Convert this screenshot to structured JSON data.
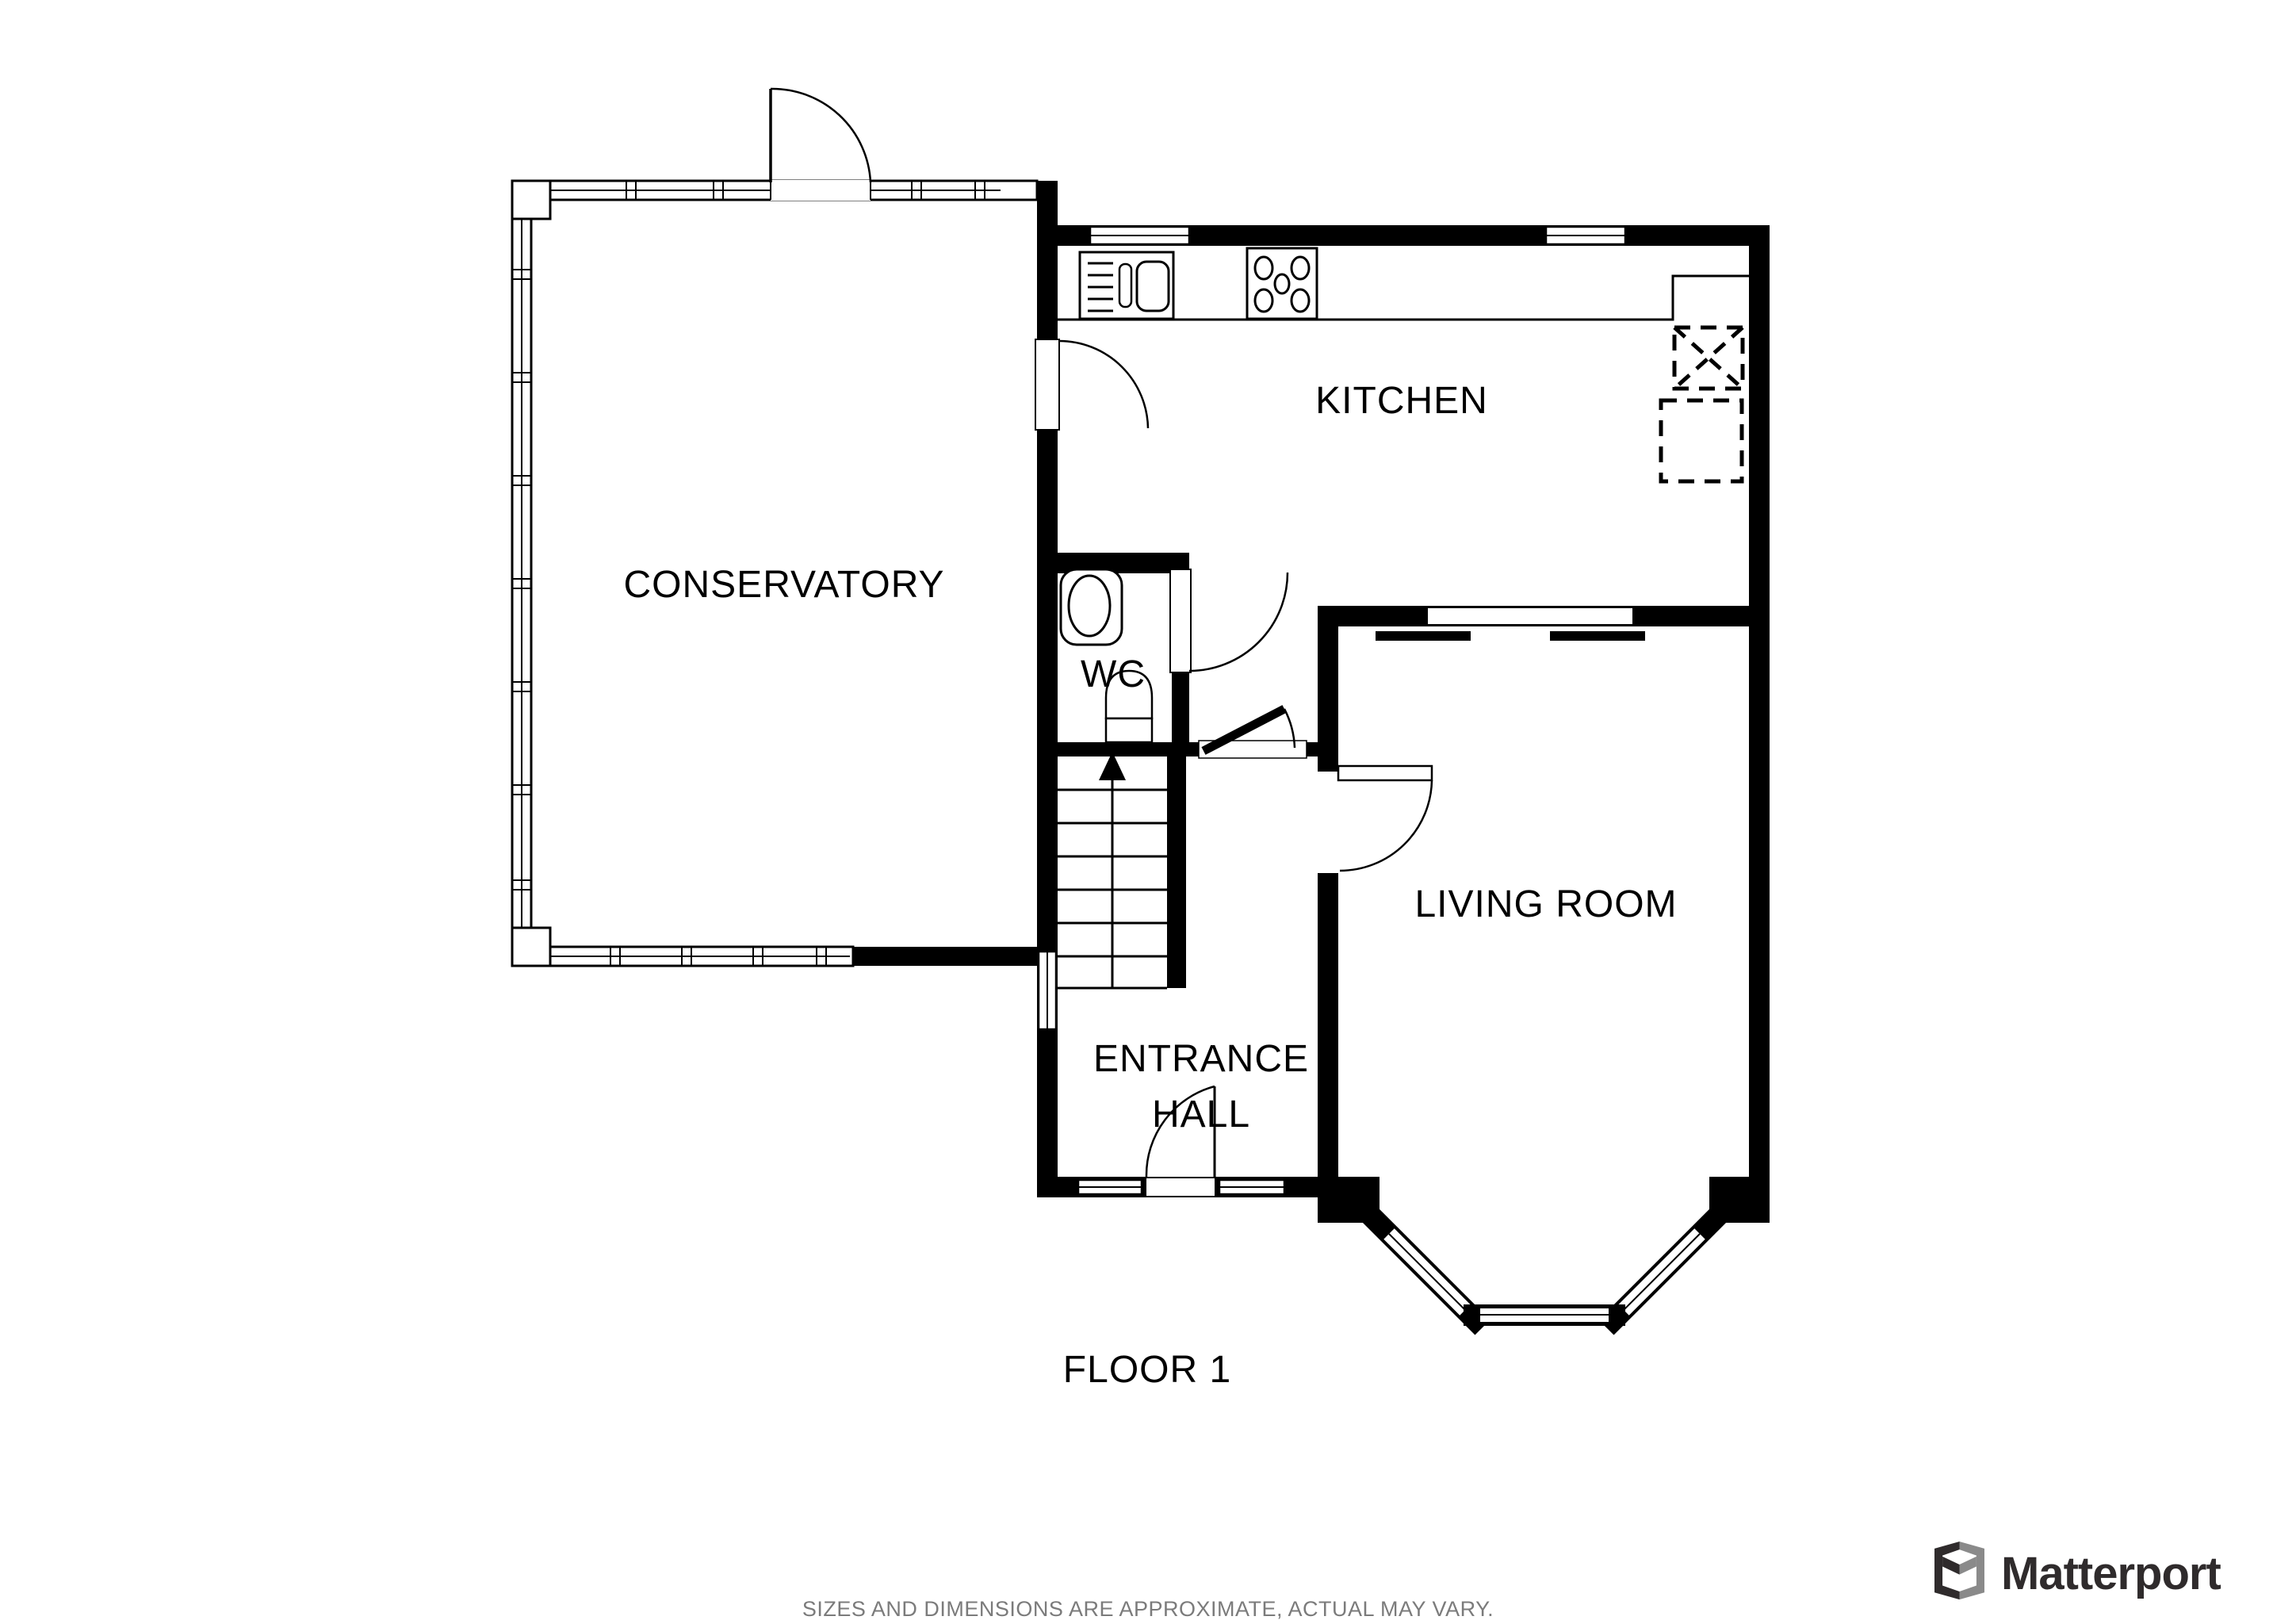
{
  "floor_plan": {
    "labels": {
      "conservatory": "CONSERVATORY",
      "kitchen": "KITCHEN",
      "wc": "WC",
      "living_room": "LIVING ROOM",
      "entrance_hall_line1": "ENTRANCE",
      "entrance_hall_line2": "HALL",
      "floor_label": "FLOOR 1"
    },
    "symbols": {
      "stairs": "staircase-up-arrow",
      "kitchen_sink": "sink-with-drainer-icon",
      "hob": "five-burner-hob-icon",
      "wc_toilet": "toilet-icon",
      "wc_basin": "wash-basin-icon",
      "appliance_1": "dashed-appliance-crossed-outline",
      "appliance_2": "dashed-appliance-outline",
      "bay_window": "bay-window",
      "doors": "quarter-swing-door-arcs"
    },
    "colors": {
      "wall": "#000000",
      "background": "#ffffff",
      "footer_text": "#7b7b7b",
      "logo_dark": "#2f2b2c",
      "logo_gray": "#8a8a8a"
    }
  },
  "footer": {
    "disclaimer": "SIZES AND DIMENSIONS ARE APPROXIMATE, ACTUAL MAY VARY."
  },
  "brand": {
    "name": "Matterport"
  }
}
